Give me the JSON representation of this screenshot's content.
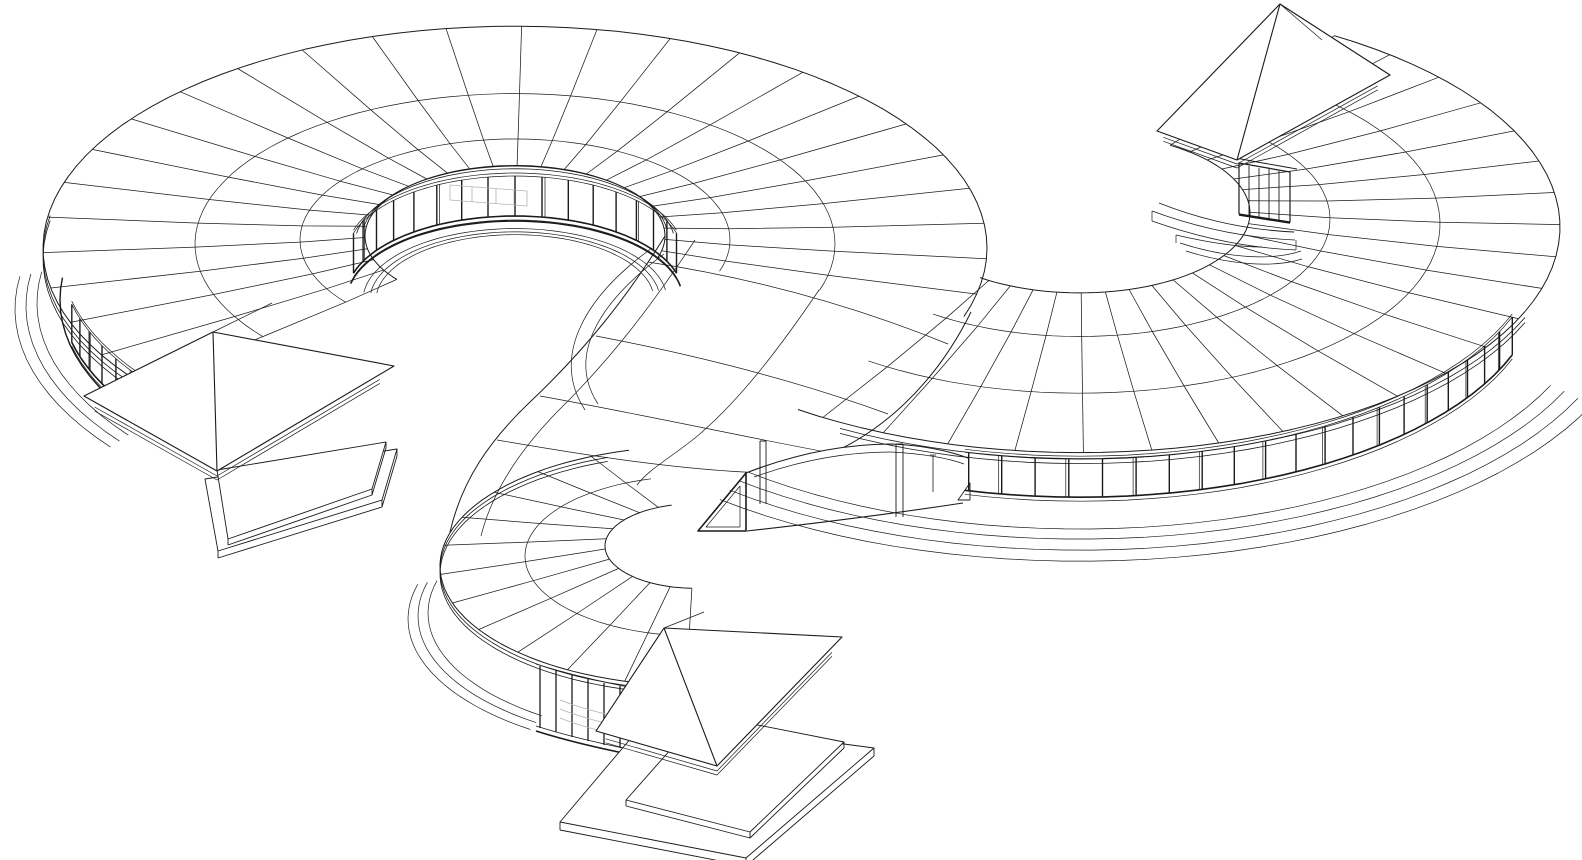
{
  "figure": {
    "kind": "architectural-axonometric-wireframe",
    "subject": "serpentine-courtyard-building-line-drawing"
  },
  "canvas": {
    "width": 1582,
    "height": 860,
    "background": "#ffffff"
  },
  "style": {
    "ink": "#1b1b1b",
    "hint": "#b3b3b3",
    "white": "#ffffff",
    "squash": 0.47,
    "thin": 0.7,
    "mid": 1.1,
    "thick": 1.7
  },
  "layers": [
    {
      "name": "ring-a-roof-mesh",
      "type": "mesh",
      "cx": 515,
      "cy": 300,
      "step": 9.2,
      "t0": 142,
      "t1": 378,
      "rings": [
        [
          150,
          64
        ],
        [
          215,
          60
        ],
        [
          320,
          56
        ],
        [
          472,
          52
        ]
      ]
    },
    {
      "name": "ring-b-roof-mesh",
      "type": "mesh",
      "cx": 1080,
      "cy": 285,
      "step": 8.2,
      "t0": 302,
      "t1": 486,
      "rings": [
        [
          170,
          72
        ],
        [
          250,
          66
        ],
        [
          360,
          61
        ],
        [
          480,
          58
        ]
      ]
    },
    {
      "name": "hook-roof-mesh",
      "type": "mesh",
      "cx": 695,
      "cy": 610,
      "step": 14,
      "t0": 92,
      "t1": 255,
      "rings": [
        [
          90,
          64
        ],
        [
          170,
          54
        ],
        [
          255,
          44
        ]
      ]
    },
    {
      "name": "transition-roof-mesh",
      "type": "free",
      "items": [
        {
          "d": "M 665 236 C 625 300 585 350 530 402 C 490 440 462 480 450 532",
          "w": 1.0
        },
        {
          "d": "M 695 240 C 650 308 610 360 557 412 C 520 450 492 492 481 536",
          "w": 0.7
        },
        {
          "d": "M 819 290 C 775 355 735 405 695 438 C 670 458 648 470 637 485",
          "w": 0.7
        },
        {
          "d": "M 971 312 C 935 385 880 435 820 458 C 795 468 770 473 748 476",
          "w": 1.0
        },
        {
          "d": "M 648 262 C 740 276 840 300 948 344",
          "w": 0.7
        },
        {
          "d": "M 596 336 C 690 354 790 378 888 414",
          "w": 0.7
        },
        {
          "d": "M 540 396 C 640 414 740 436 826 452",
          "w": 0.7
        },
        {
          "d": "M 497 440 C 590 456 680 470 764 473",
          "w": 0.7
        },
        {
          "d": "M 652 248 C 580 300 552 360 585 410",
          "w": 0.7
        },
        {
          "d": "M 664 254 C 595 305 568 358 598 404",
          "w": 0.7
        }
      ]
    },
    {
      "name": "south-porch-wall",
      "type": "free",
      "items": [
        {
          "d": "M 746 473 C 800 452 850 444 893 444 C 930 446 952 452 968 458 L 968 508 C 890 518 820 527 747 532 L 698 532 L 698 524 C 716 508 732 491 746 473 Z",
          "w": 0,
          "f": "#ffffff",
          "c": "none"
        },
        {
          "d": "M 746 473 C 800 452 850 444 893 444 C 930 446 952 452 968 458",
          "w": 1.1
        },
        {
          "d": "M 754 477 C 804 459 850 452 891 452 C 926 454 948 458 964 464",
          "w": 0.7
        },
        {
          "d": "M 747 531 C 820 523 890 514 963 503",
          "w": 1.1
        }
      ]
    },
    {
      "name": "courtyard-1-inner-eave",
      "type": "arcs",
      "cx": 515,
      "cy": 300,
      "t0": 188,
      "t1": 352,
      "w": 0.8,
      "arcs": [
        [
          153,
          62
        ],
        [
          160,
          56
        ]
      ]
    },
    {
      "name": "courtyard-1-window-band",
      "type": "band",
      "cx": 515,
      "cy": 300,
      "r": 168,
      "t0": 196,
      "t1": 344,
      "step": 9.25,
      "z0": 5,
      "z1": 45,
      "every": 4
    },
    {
      "name": "courtyard-1-wall-base",
      "type": "arcs",
      "cx": 515,
      "cy": 300,
      "t0": 192,
      "t1": 350,
      "w": 1.6,
      "arcs": [
        [
          168,
          0
        ]
      ]
    },
    {
      "name": "courtyard-1-floor-terraces",
      "type": "arcs",
      "cx": 515,
      "cy": 300,
      "t0": 186,
      "t1": 352,
      "w": 0.7,
      "arcs": [
        [
          152,
          0
        ],
        [
          145,
          0
        ],
        [
          139,
          0
        ]
      ]
    },
    {
      "name": "ring-a-outer-eave-fascia",
      "type": "arcs",
      "cx": 515,
      "cy": 300,
      "t0": 139,
      "t1": 190,
      "w": 0.8,
      "arcs": [
        [
          472,
          46
        ],
        [
          472,
          41
        ]
      ]
    },
    {
      "name": "ring-a-outer-wall-base",
      "type": "arcs",
      "cx": 515,
      "cy": 300,
      "t0": 141,
      "t1": 186,
      "w": 1.4,
      "arcs": [
        [
          455,
          0
        ]
      ]
    },
    {
      "name": "ring-a-outer-window-band",
      "type": "band",
      "cx": 515,
      "cy": 300,
      "r": 455,
      "t0": 143.5,
      "t1": 167,
      "step": 3.9,
      "z0": 6,
      "z1": 44,
      "every": 3
    },
    {
      "name": "ring-a-outer-terraces",
      "type": "arcs",
      "cx": 515,
      "cy": 300,
      "t0": 144,
      "t1": 188,
      "w": 0.7,
      "arcs": [
        [
          478,
          -3
        ],
        [
          489,
          -6
        ],
        [
          500,
          -9
        ]
      ]
    },
    {
      "name": "ring-b-eave-fascia",
      "type": "arcs",
      "cx": 1080,
      "cy": 285,
      "t0": 22,
      "t1": 120,
      "w": 0.8,
      "arcs": [
        [
          480,
          52
        ],
        [
          480,
          47
        ]
      ]
    },
    {
      "name": "ring-b-south-window-band",
      "type": "band",
      "cx": 1080,
      "cy": 285,
      "r": 460,
      "t0": 20,
      "t1": 104.5,
      "step": 4.2,
      "z0": 4,
      "z1": 42,
      "every": 2
    },
    {
      "name": "ring-b-outer-terraces",
      "type": "arcs",
      "cx": 1080,
      "cy": 285,
      "t0": 24,
      "t1": 130,
      "w": 0.7,
      "arcs": [
        [
          515,
          -2
        ],
        [
          530,
          -5
        ],
        [
          545,
          -9
        ],
        [
          560,
          -13
        ]
      ]
    },
    {
      "name": "porch-end-brace",
      "type": "free",
      "items": [
        {
          "d": "M 958 500 L 970 500 L 970 483 Z",
          "w": 0.9
        }
      ]
    },
    {
      "name": "hook-eave-fascia",
      "type": "arcs",
      "cx": 695,
      "cy": 610,
      "t0": 95,
      "t1": 250,
      "w": 0.8,
      "arcs": [
        [
          255,
          40
        ],
        [
          255,
          36
        ]
      ]
    },
    {
      "name": "hook-outer-terraces",
      "type": "arcs",
      "cx": 695,
      "cy": 610,
      "t0": 125,
      "t1": 195,
      "w": 0.7,
      "arcs": [
        [
          267,
          -3
        ],
        [
          277,
          -6
        ],
        [
          287,
          -9
        ]
      ]
    },
    {
      "name": "hook-colonnade-windows",
      "type": "free",
      "items": [
        {
          "d": "M 536 664 C 580 678 630 688 676 696",
          "w": 0.9
        },
        {
          "d": "M 536 726 C 580 740 630 750 676 758",
          "w": 0.9
        },
        {
          "d": "M 536 731 C 580 745 630 755 676 763",
          "w": 1.6
        },
        {
          "d": "M 540 666 L 540 728",
          "w": 1.3
        },
        {
          "d": "M 556 670 L 556 732",
          "w": 1.3
        },
        {
          "d": "M 572 675 L 572 737",
          "w": 1.3
        },
        {
          "d": "M 588 679 L 588 741",
          "w": 1.3
        },
        {
          "d": "M 604 683 L 604 745",
          "w": 1.3
        },
        {
          "d": "M 620 686 L 620 748",
          "w": 1.3
        },
        {
          "d": "M 636 689 L 636 751",
          "w": 1.3
        },
        {
          "d": "M 652 692 L 652 754",
          "w": 1.3
        },
        {
          "d": "M 668 695 L 668 757",
          "w": 1.3
        }
      ]
    },
    {
      "name": "porch-posts-and-brace",
      "type": "free",
      "items": [
        {
          "d": "M 760 441 L 760 504 M 766 441 L 766 504 M 760 441 L 766 441",
          "w": 0.9
        },
        {
          "d": "M 896 444 L 896 517 M 903 444 L 903 517 M 896 444 L 903 444",
          "w": 0.9
        },
        {
          "d": "M 933 455 L 933 492 M 930 455 L 936 455",
          "w": 0.8
        },
        {
          "d": "M 698 531 L 746 531 L 746 473 Z",
          "w": 1.6
        },
        {
          "d": "M 706 527 L 740 527 L 740 486 Z",
          "w": 0.7
        }
      ]
    },
    {
      "name": "ne-curl-end-details",
      "type": "free",
      "items": [
        {
          "d": "M 1239 163 L 1239 214 L 1290 222 L 1290 172 Z",
          "w": 1.2
        },
        {
          "d": "M 1249 166 L 1249 216",
          "w": 0.9
        },
        {
          "d": "M 1259 168 L 1259 217",
          "w": 0.9
        },
        {
          "d": "M 1269 169 L 1269 219",
          "w": 0.9
        },
        {
          "d": "M 1279 171 L 1279 220",
          "w": 0.9
        },
        {
          "d": "M 1239 215 L 1290 223",
          "w": 1.6
        },
        {
          "d": "M 1231 157 C 1256 162 1280 166 1297 169",
          "w": 0.9
        },
        {
          "d": "M 1159 203 C 1202 220 1248 230 1294 232",
          "w": 0.9
        },
        {
          "d": "M 1152 211 C 1198 228 1246 238 1295 240",
          "w": 0.7
        },
        {
          "d": "M 1152 211 L 1152 221",
          "w": 0.7
        },
        {
          "d": "M 1152 221 C 1200 238 1248 248 1296 250",
          "w": 0.7
        },
        {
          "d": "M 1296 240 L 1296 250",
          "w": 0.7
        },
        {
          "d": "M 1180 243 C 1226 258 1272 261 1301 251",
          "w": 0.7
        },
        {
          "d": "M 1186 251 C 1230 265 1274 268 1302 259",
          "w": 0.7
        },
        {
          "d": "M 1176 235 C 1206 242 1238 247 1262 247",
          "w": 0.7
        },
        {
          "d": "M 1176 235 L 1176 243",
          "w": 0.7
        }
      ]
    },
    {
      "name": "interior-hints",
      "type": "free",
      "items": [
        {
          "d": "M 450 185 L 527 191 L 527 206 L 450 200 Z",
          "w": 0.8,
          "c": "#b3b3b3"
        },
        {
          "d": "M 472 187 L 472 202",
          "w": 0.8,
          "c": "#b3b3b3"
        },
        {
          "d": "M 496 188 L 496 204",
          "w": 0.8,
          "c": "#b3b3b3"
        },
        {
          "d": "M 514 190 L 514 205",
          "w": 0.8,
          "c": "#b3b3b3"
        },
        {
          "d": "M 560 700 C 585 710 612 716 636 720",
          "w": 0.8,
          "c": "#b3b3b3"
        },
        {
          "d": "M 560 709 C 585 719 612 725 636 729",
          "w": 0.8,
          "c": "#b3b3b3"
        },
        {
          "d": "M 560 718 C 585 728 612 734 636 738",
          "w": 0.8,
          "c": "#b3b3b3"
        }
      ]
    },
    {
      "name": "pavilion-1-platform",
      "type": "slab",
      "slabs": [
        {
          "pts": [
            [
              205,
              479
            ],
            [
              397,
              449
            ],
            [
              382,
              500
            ],
            [
              218,
              551
            ]
          ],
          "th": 7
        },
        {
          "pts": [
            [
              217,
              470
            ],
            [
              386,
              442
            ],
            [
              372,
              489
            ],
            [
              228,
              539
            ]
          ],
          "th": 6
        }
      ]
    },
    {
      "name": "pavilion-1-pyramid",
      "type": "pavilion",
      "apex": [
        213,
        332
      ],
      "wc": [
        84,
        396
      ],
      "sc": [
        217,
        471
      ],
      "ec": [
        394,
        366
      ],
      "back": [
        272,
        303
      ],
      "fascia": [
        5,
        9
      ]
    },
    {
      "name": "pavilion-2-platform",
      "type": "slab",
      "slabs": [
        {
          "pts": [
            [
              648,
              718
            ],
            [
              874,
              748
            ],
            [
              746,
              858
            ],
            [
              560,
              822
            ]
          ],
          "th": 8
        },
        {
          "pts": [
            [
              702,
              714
            ],
            [
              844,
              742
            ],
            [
              750,
              832
            ],
            [
              626,
              800
            ]
          ],
          "th": 6
        }
      ]
    },
    {
      "name": "pavilion-2-pyramid",
      "type": "pavilion",
      "apex": [
        664,
        628
      ],
      "wc": [
        596,
        731
      ],
      "sc": [
        717,
        766
      ],
      "ec": [
        842,
        637
      ],
      "back": [
        704,
        612
      ],
      "fascia": [
        5,
        9
      ]
    },
    {
      "name": "pavilion-3-pyramid",
      "type": "pavilion",
      "apex": [
        1280,
        4
      ],
      "wc": [
        1157,
        131
      ],
      "sc": [
        1237,
        160
      ],
      "ec": [
        1390,
        75
      ],
      "back": [
        1322,
        40
      ],
      "fascia": [
        4,
        8
      ]
    }
  ]
}
